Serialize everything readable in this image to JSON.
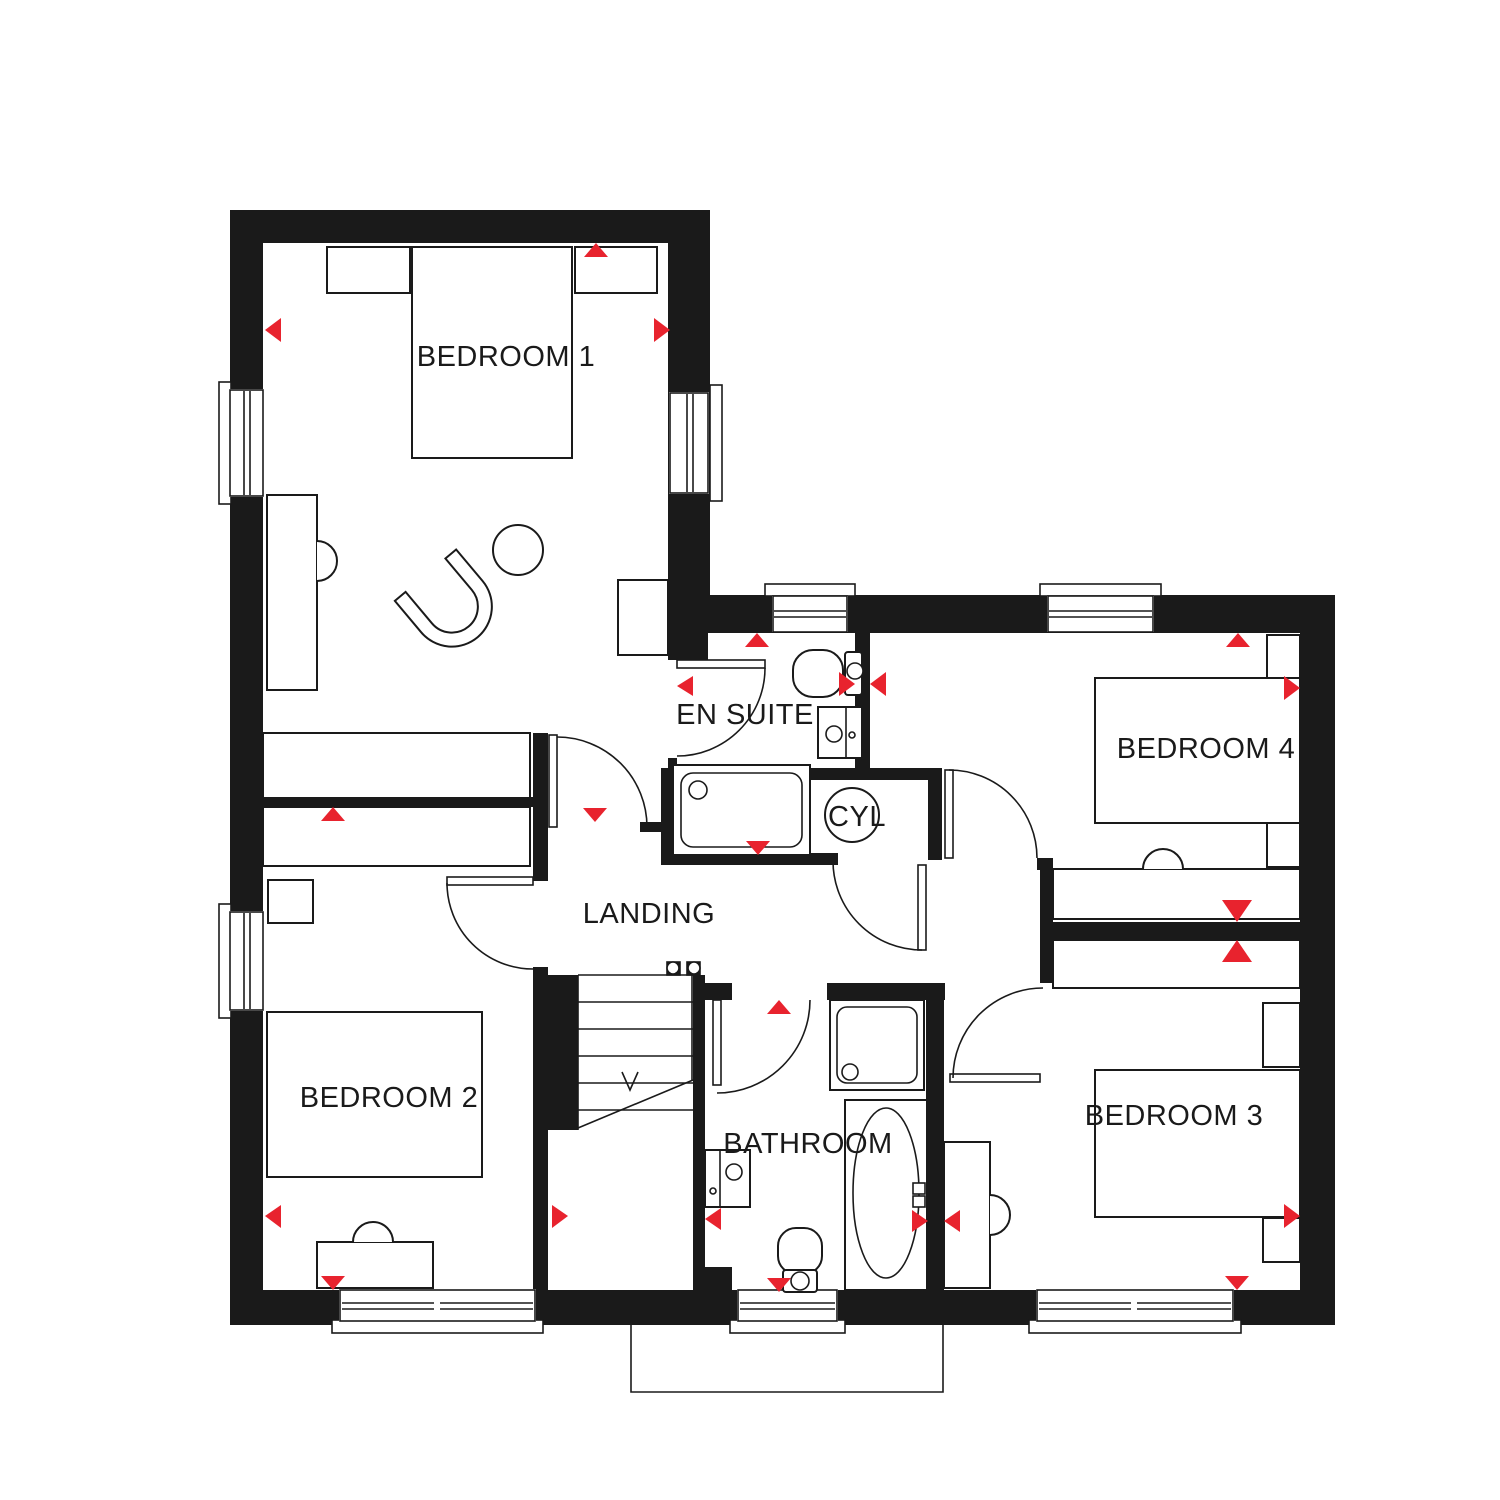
{
  "plan": {
    "colors": {
      "background": "#ffffff",
      "walls": "#1a1a1a",
      "lines": "#1a1a1a",
      "marker": "#e8232e"
    },
    "rooms": {
      "bedroom1": {
        "label": "BEDROOM 1"
      },
      "bedroom2": {
        "label": "BEDROOM 2"
      },
      "bedroom3": {
        "label": "BEDROOM 3"
      },
      "bedroom4": {
        "label": "BEDROOM 4"
      },
      "ensuite": {
        "label": "EN SUITE"
      },
      "bathroom": {
        "label": "BATHROOM"
      },
      "landing": {
        "label": "LANDING"
      },
      "cylinder": {
        "label": "CYL"
      }
    }
  }
}
